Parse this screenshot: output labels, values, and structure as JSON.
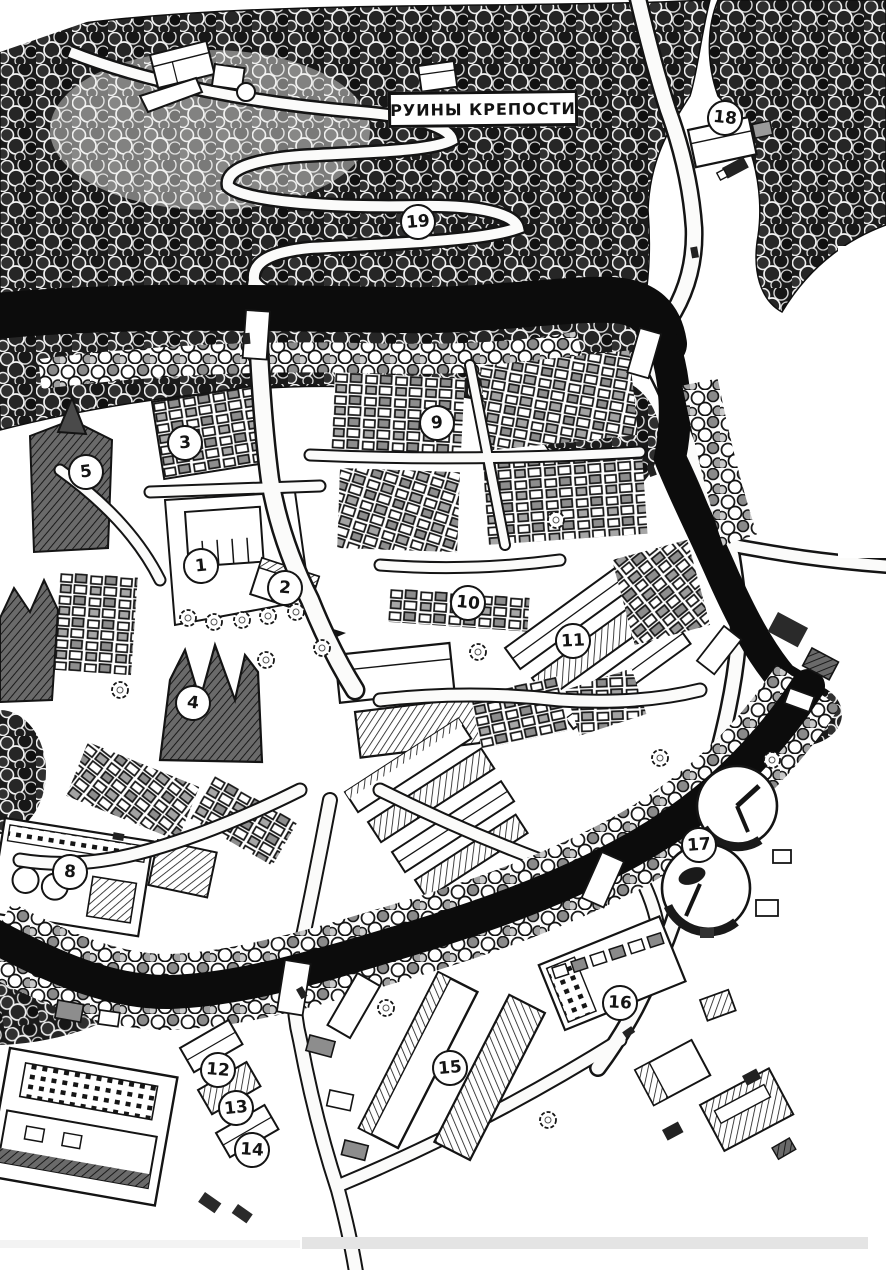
{
  "map_label": {
    "text": "РУИНЫ КРЕПОСТИ"
  },
  "colors": {
    "ink": "#141414",
    "paper": "#ffffff",
    "river": "#0c0c0c",
    "scan_shadow": "#e4e4e4"
  },
  "markers": [
    {
      "number": "1",
      "x": 201,
      "y": 566
    },
    {
      "number": "2",
      "x": 285,
      "y": 588
    },
    {
      "number": "3",
      "x": 185,
      "y": 443
    },
    {
      "number": "4",
      "x": 193,
      "y": 703
    },
    {
      "number": "5",
      "x": 86,
      "y": 472
    },
    {
      "number": "8",
      "x": 70,
      "y": 872
    },
    {
      "number": "9",
      "x": 437,
      "y": 423
    },
    {
      "number": "10",
      "x": 468,
      "y": 603
    },
    {
      "number": "11",
      "x": 573,
      "y": 641
    },
    {
      "number": "12",
      "x": 218,
      "y": 1070
    },
    {
      "number": "13",
      "x": 236,
      "y": 1108
    },
    {
      "number": "14",
      "x": 252,
      "y": 1150
    },
    {
      "number": "15",
      "x": 450,
      "y": 1068
    },
    {
      "number": "16",
      "x": 620,
      "y": 1003
    },
    {
      "number": "17",
      "x": 699,
      "y": 845
    },
    {
      "number": "18",
      "x": 725,
      "y": 118
    },
    {
      "number": "19",
      "x": 418,
      "y": 222
    }
  ]
}
